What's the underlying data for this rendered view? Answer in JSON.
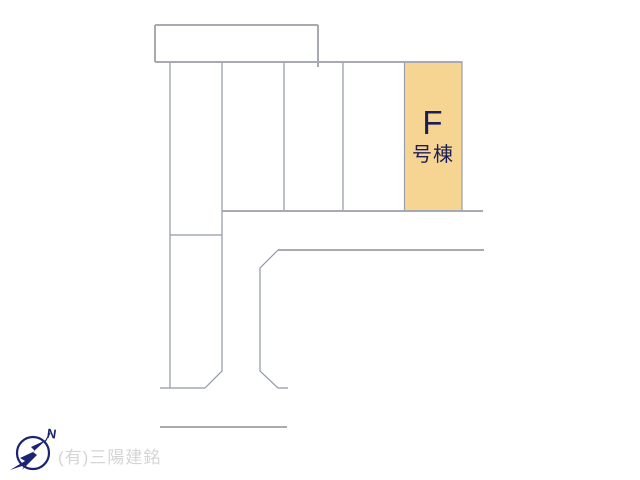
{
  "plan": {
    "highlight_plot": {
      "name": "F号棟",
      "label_line1": "F",
      "label_line2": "号棟",
      "fill": "#f6d593",
      "border": "#9aa0ab",
      "text_color": "#1d1d55"
    },
    "line_color": "#9096a8",
    "major_line_color": "#a8aab2",
    "background": "#ffffff"
  },
  "compass": {
    "label": "N",
    "color": "#1c2472"
  },
  "watermark": {
    "text": "(有)三陽建銘",
    "color": "#d4d4d4"
  }
}
